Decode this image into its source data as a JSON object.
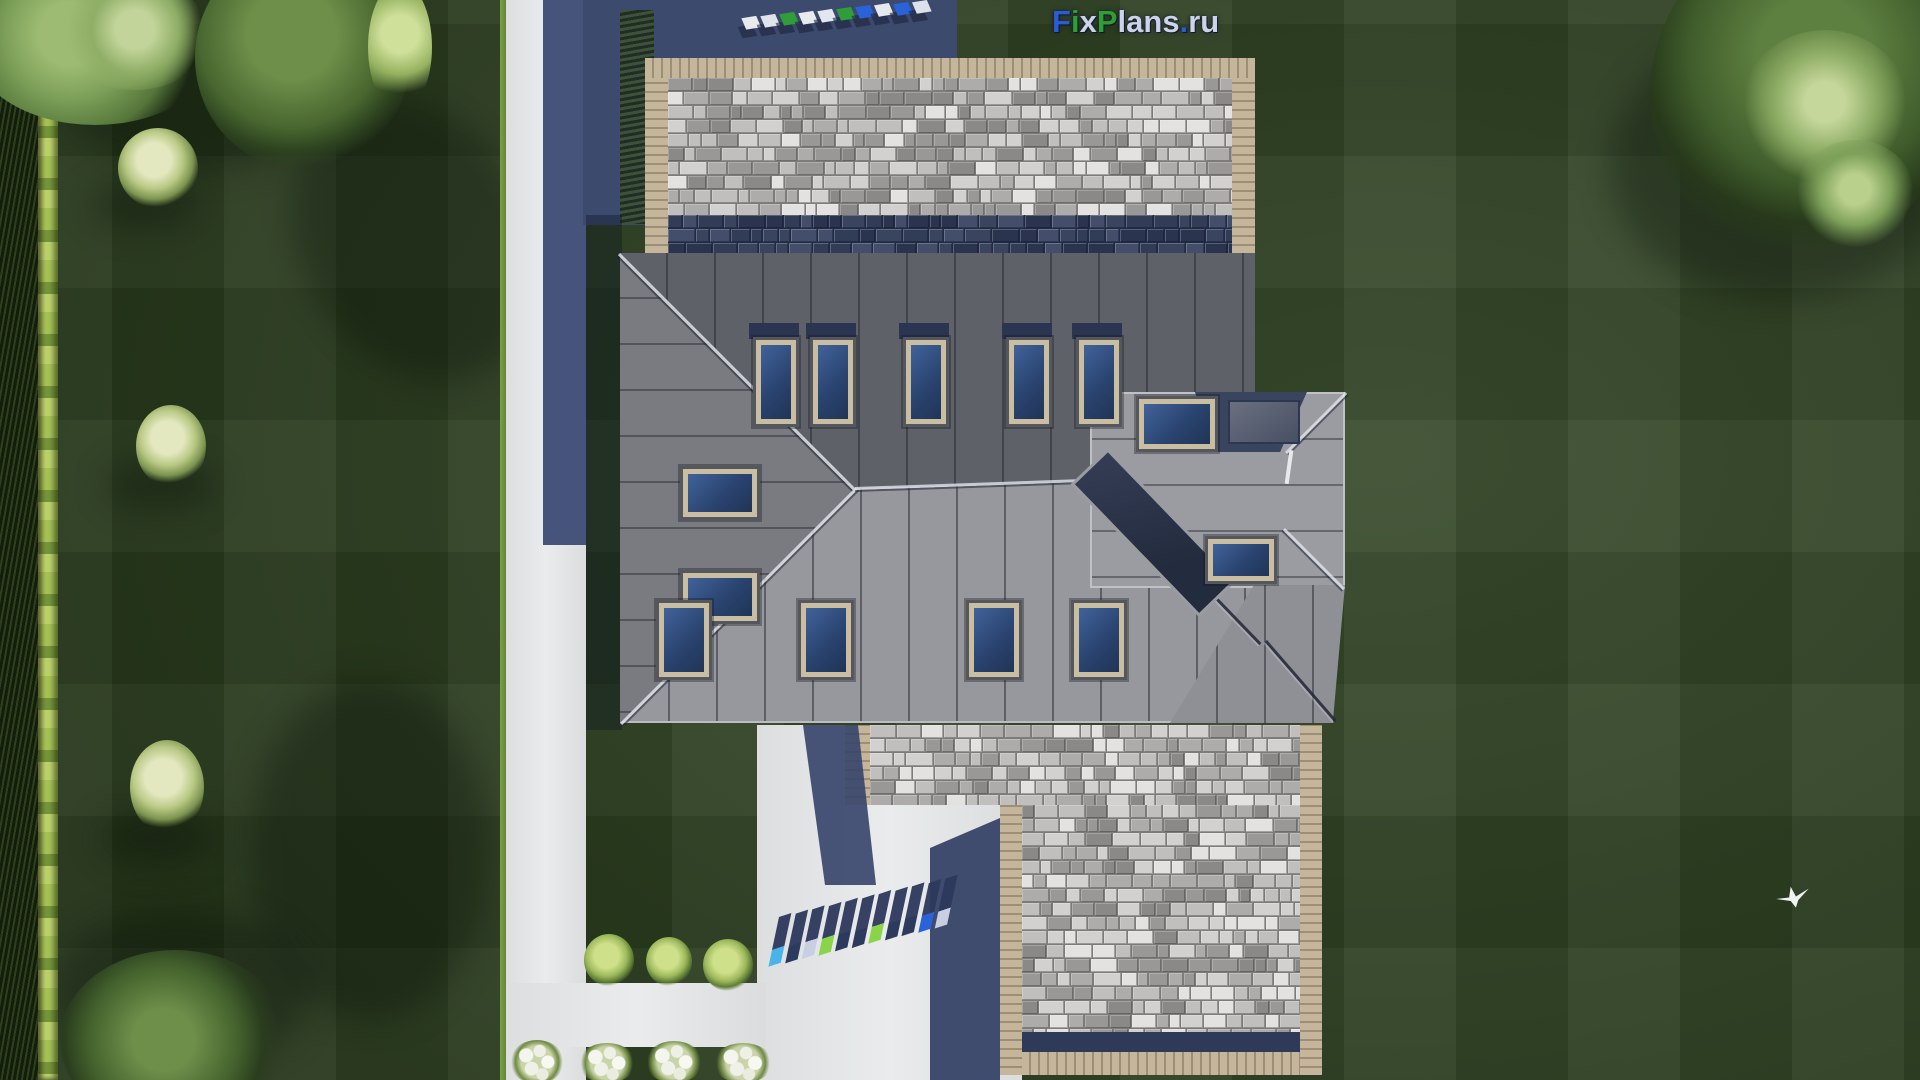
{
  "logo": {
    "text": "FixPlans.ru",
    "letters": [
      {
        "ch": "F",
        "color": "#2b5bd7"
      },
      {
        "ch": "i",
        "color": "#2f9e33"
      },
      {
        "ch": "x",
        "color": "#ccd3ea"
      },
      {
        "ch": "P",
        "color": "#2f9e33"
      },
      {
        "ch": "l",
        "color": "#ccd3ea"
      },
      {
        "ch": "a",
        "color": "#ccd3ea"
      },
      {
        "ch": "n",
        "color": "#ccd3ea"
      },
      {
        "ch": "s",
        "color": "#ccd3ea"
      },
      {
        "ch": ".",
        "color": "#2b5bd7"
      },
      {
        "ch": "r",
        "color": "#ccd3ea"
      },
      {
        "ch": "u",
        "color": "#ccd3ea"
      }
    ]
  },
  "watermarks": {
    "top": {
      "text": "FixPlans.ru",
      "block_colors": [
        "#e8eaee",
        "#dfe3ea",
        "#2f9e3a",
        "#e8eaee",
        "#e2e6ee",
        "#2f9e3a",
        "#2a62d8",
        "#e6e9ee",
        "#2a62d8",
        "#dde2ea"
      ]
    },
    "bottom": {
      "text": "FixPlans.ru",
      "block_colors": [
        "#49b4ea",
        "#2c3a5e",
        "#c8cfe2",
        "#8ad44a",
        "#2c3a5e",
        "#2c3a5e",
        "#8ad44a",
        "#2c3a5e",
        "#2c3a5e",
        "#2a62d8",
        "#c8cfe2"
      ]
    }
  },
  "palette": {
    "grass": "#2b3f1e",
    "hedge": "#8fae46",
    "walkway_white": "#e9eaeb",
    "shadow_navy": "#3c4a6e",
    "shadow_on_white": "#46537b",
    "paver_border_tan": "#b3a489",
    "paver_shades": [
      "#e3e2e0",
      "#d2d1cf",
      "#c0bfbd",
      "#adacaa",
      "#999896",
      "#8a8987"
    ],
    "paver_navy_shades": [
      "#39445f",
      "#313c57",
      "#2a344e",
      "#434e6a"
    ],
    "roof_dark_slope": "#5f6168",
    "roof_medium_slope": "#7a7b80",
    "roof_light_slope": "#97989d",
    "roof_wing": "#9b9ca1",
    "skylight_glass": "#2a4470",
    "skylight_frame": "#c9bda2",
    "terrace_glass": "#2b3347",
    "chimney": "#4a5265"
  },
  "scene": {
    "house": {
      "skylight_count_top_row": 5,
      "skylight_count_left_slope": 2,
      "skylight_count_bottom_row": 4,
      "skylight_count_wing": 2
    },
    "icons": {
      "bird": "white-bird-icon",
      "trees": "tree-canopy-icon",
      "flowers": "white-flower-bush-icon"
    }
  }
}
